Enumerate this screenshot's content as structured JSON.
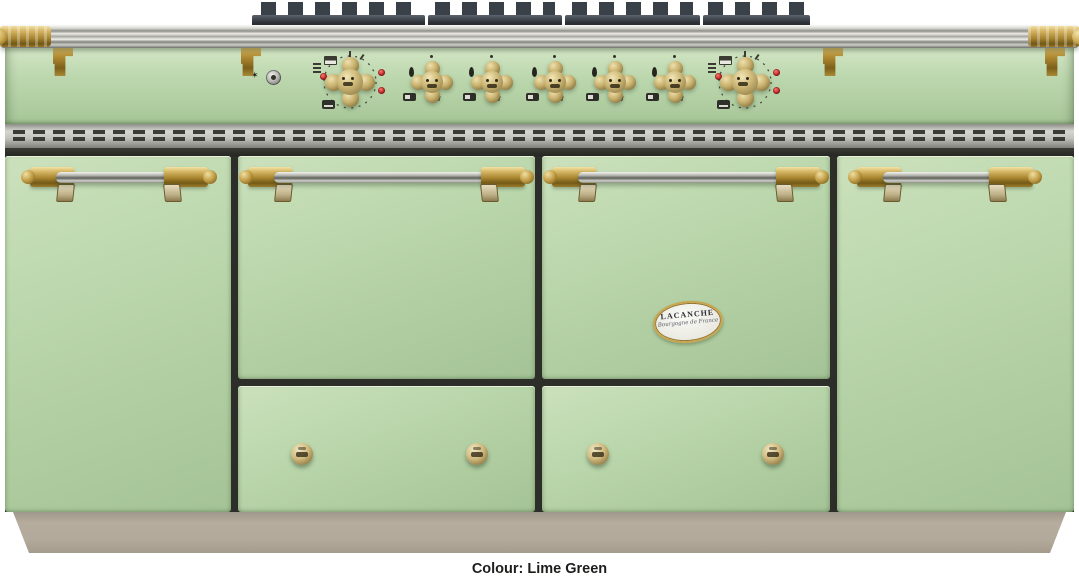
{
  "product": {
    "brand": "LACANCHE",
    "badge_tagline": "Bourgogne de France",
    "caption": "Colour: Lime Green"
  },
  "appearance": {
    "body_color_name": "Lime Green",
    "body_green": "#b8d4a9",
    "body_green_light": "#cce3bd",
    "body_green_dark": "#a2c194",
    "trim_brass": "#b8964a",
    "trim_steel": "#c6c6c0",
    "plinth_taupe": "#b2a99b",
    "grate_black": "#343940",
    "indicator_red": "#c1272d",
    "caption_text_color": "#1d1d1b"
  },
  "controls": {
    "ignition_button": "spark-ignition-button",
    "thermostat_knobs": [
      "left-oven-thermostat",
      "right-oven-thermostat"
    ],
    "burner_knobs": [
      "burner-1",
      "burner-2",
      "burner-3",
      "burner-4",
      "burner-5"
    ],
    "indicator_lights_per_oven": 3
  },
  "sections": {
    "left_cupboard": "storage-cupboard-door",
    "left_oven": "oven-door",
    "right_oven": "oven-door-with-badge",
    "right_cupboard": "storage-cupboard-door",
    "drawer_count": 2
  }
}
